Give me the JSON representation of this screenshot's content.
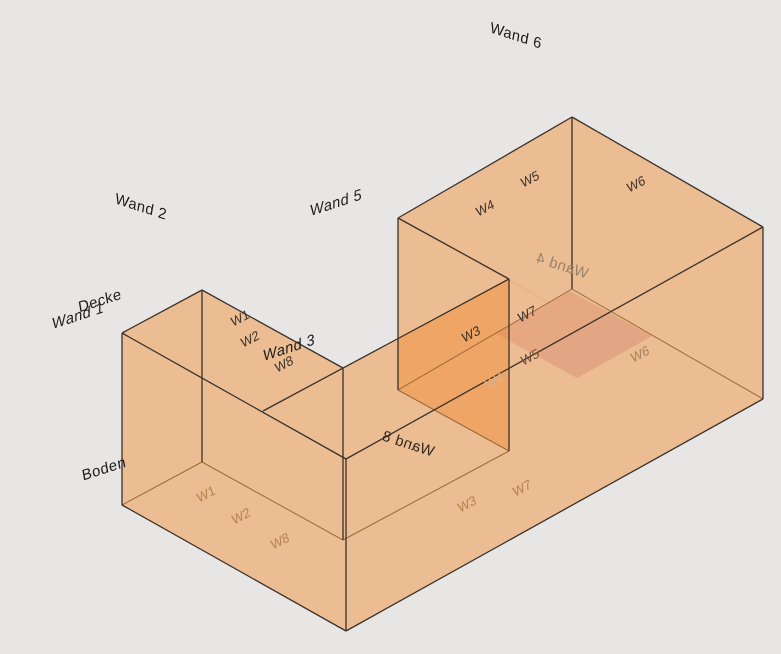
{
  "scene": {
    "background": "#e7e6e4",
    "face_color": "#f48c2e",
    "face_opacity": 0.26,
    "pink_face_color": "#cd6e64",
    "pink_face_opacity": 0.28,
    "edge_color": "#3a322b",
    "hidden_edge_color": "#9a6a38",
    "view_width": 781,
    "view_height": 654
  },
  "geometry": {
    "points": {
      "B": [
        122,
        333
      ],
      "A": [
        202,
        290
      ],
      "C": [
        343,
        368
      ],
      "D": [
        263,
        411
      ],
      "M": [
        509,
        279
      ],
      "W": [
        398,
        218
      ],
      "N": [
        572,
        117
      ],
      "E": [
        763,
        227
      ],
      "S": [
        346,
        459
      ],
      "T": [
        588,
        325
      ],
      "Bf": [
        122,
        505
      ],
      "Af": [
        202,
        462
      ],
      "Cf": [
        343,
        540
      ],
      "Mf": [
        509,
        451
      ],
      "Wf": [
        398,
        390
      ],
      "Nf": [
        572,
        289
      ],
      "Ef": [
        763,
        399
      ],
      "Sf": [
        346,
        631
      ],
      "P1": [
        570,
        291
      ],
      "P2": [
        652,
        336
      ],
      "P3": [
        577,
        378
      ],
      "P4": [
        495,
        333
      ]
    },
    "faces": [
      {
        "id": "floor-boden",
        "pts": [
          "Bf",
          "Af",
          "Cf",
          "Mf",
          "Wf",
          "Nf",
          "Ef",
          "Sf"
        ]
      },
      {
        "id": "wall-north-tall",
        "pts": [
          "W",
          "N",
          "Nf",
          "Wf"
        ]
      },
      {
        "id": "wall-east-tall",
        "pts": [
          "N",
          "E",
          "Ef",
          "Nf"
        ]
      },
      {
        "id": "wall-west-tall",
        "pts": [
          "W",
          "M",
          "Mf",
          "Wf"
        ]
      },
      {
        "id": "wall-notch-north",
        "pts": [
          "C",
          "M",
          "Mf",
          "Cf"
        ]
      },
      {
        "id": "wall-left-ne",
        "pts": [
          "A",
          "C",
          "Cf",
          "Af"
        ]
      },
      {
        "id": "wall-left-nw",
        "pts": [
          "B",
          "A",
          "Af",
          "Bf"
        ]
      },
      {
        "id": "wall-left-sw",
        "pts": [
          "B",
          "S",
          "Sf",
          "Bf"
        ]
      },
      {
        "id": "wall-south-long",
        "pts": [
          "S",
          "E",
          "Ef",
          "Sf"
        ]
      },
      {
        "id": "floor-highlight",
        "pts": [
          "P1",
          "P2",
          "P3",
          "P4"
        ],
        "special": "pink"
      },
      {
        "id": "roof-tall-wing",
        "pts": [
          "W",
          "N",
          "E",
          "T"
        ]
      },
      {
        "id": "ceiling-strip",
        "pts": [
          "D",
          "M",
          "T",
          "S"
        ]
      },
      {
        "id": "ceiling-left-panel",
        "pts": [
          "B",
          "A",
          "C",
          "D"
        ]
      }
    ],
    "edges": [
      [
        "B",
        "A"
      ],
      [
        "A",
        "C"
      ],
      [
        "D",
        "M"
      ],
      [
        "W",
        "M"
      ],
      [
        "W",
        "N"
      ],
      [
        "N",
        "E"
      ],
      [
        "S",
        "E"
      ],
      [
        "B",
        "S"
      ],
      [
        "B",
        "Bf"
      ],
      [
        "A",
        "Af"
      ],
      [
        "C",
        "Cf"
      ],
      [
        "S",
        "Sf"
      ],
      [
        "M",
        "Mf"
      ],
      [
        "W",
        "Wf"
      ],
      [
        "N",
        "Nf"
      ],
      [
        "E",
        "Ef"
      ],
      [
        "Bf",
        "Sf"
      ],
      [
        "Sf",
        "Ef"
      ]
    ],
    "hidden_edges": [
      [
        "Bf",
        "Af"
      ],
      [
        "Af",
        "Cf"
      ],
      [
        "Cf",
        "Mf"
      ],
      [
        "Mf",
        "Wf"
      ],
      [
        "Wf",
        "Nf"
      ],
      [
        "Nf",
        "Ef"
      ]
    ]
  },
  "labels": {
    "large": [
      {
        "id": "wall-label-wand-6",
        "text": "Wand 6",
        "x": 516,
        "y": 36,
        "rot": 18,
        "skew": 8,
        "mirror": false,
        "italic": false,
        "color": "#1c1c1c"
      },
      {
        "id": "wall-label-wand-2",
        "text": "Wand 2",
        "x": 141,
        "y": 207,
        "rot": 18,
        "skew": 8,
        "mirror": false,
        "italic": false,
        "color": "#1c1c1c"
      },
      {
        "id": "wall-label-wand-5",
        "text": "Wand 5",
        "x": 336,
        "y": 203,
        "rot": -18,
        "skew": -8,
        "mirror": false,
        "italic": true,
        "color": "#1c1c1c"
      },
      {
        "id": "ceiling-label-decke",
        "text": "Decke",
        "x": 100,
        "y": 301,
        "rot": -18,
        "skew": -8,
        "mirror": false,
        "italic": false,
        "color": "#1c1c1c"
      },
      {
        "id": "wall-label-wand-1",
        "text": "Wand 1",
        "x": 78,
        "y": 316,
        "rot": -18,
        "skew": -8,
        "mirror": false,
        "italic": true,
        "color": "#1c1c1c"
      },
      {
        "id": "wall-label-wand-3",
        "text": "Wand 3",
        "x": 289,
        "y": 348,
        "rot": -18,
        "skew": -8,
        "mirror": false,
        "italic": true,
        "color": "#1c1c1c"
      },
      {
        "id": "floor-label-boden",
        "text": "Boden",
        "x": 104,
        "y": 469,
        "rot": -18,
        "skew": -8,
        "mirror": false,
        "italic": false,
        "color": "#1c1c1c"
      },
      {
        "id": "wall-label-wand-4",
        "text": "Wand 4",
        "x": 562,
        "y": 266,
        "rot": 18,
        "skew": 0,
        "mirror": true,
        "italic": false,
        "color": "#97846d"
      },
      {
        "id": "wall-label-wand-8",
        "text": "Wand 8",
        "x": 408,
        "y": 444,
        "rot": 18,
        "skew": 0,
        "mirror": true,
        "italic": false,
        "color": "#33291f"
      }
    ],
    "small": [
      {
        "id": "surface-label-w1-ceiling",
        "text": "W1",
        "x": 240,
        "y": 318,
        "color": "#3a322b"
      },
      {
        "id": "surface-label-w2-ceiling",
        "text": "W2",
        "x": 250,
        "y": 339,
        "color": "#3a322b"
      },
      {
        "id": "surface-label-w8-ceiling",
        "text": "W8",
        "x": 284,
        "y": 364,
        "color": "#3a322b"
      },
      {
        "id": "surface-label-w4-roof",
        "text": "W4",
        "x": 485,
        "y": 208,
        "color": "#3a322b"
      },
      {
        "id": "surface-label-w5-roof",
        "text": "W5",
        "x": 530,
        "y": 179,
        "color": "#3a322b"
      },
      {
        "id": "surface-label-w6-roof",
        "text": "W6",
        "x": 636,
        "y": 184,
        "color": "#3a322b"
      },
      {
        "id": "surface-label-w3-wall",
        "text": "W3",
        "x": 471,
        "y": 334,
        "color": "#3a322b"
      },
      {
        "id": "surface-label-w7-wall",
        "text": "W7",
        "x": 527,
        "y": 314,
        "color": "#3a322b"
      },
      {
        "id": "surface-label-w5-inner",
        "text": "W5",
        "x": 530,
        "y": 357,
        "color": "#6d4c35"
      },
      {
        "id": "surface-label-w4-inner",
        "text": "W4",
        "x": 494,
        "y": 381,
        "color": "#d9b38c"
      },
      {
        "id": "surface-label-w6-inner",
        "text": "W6",
        "x": 640,
        "y": 354,
        "color": "#a8805c"
      },
      {
        "id": "surface-label-w1-floor",
        "text": "W1",
        "x": 206,
        "y": 494,
        "color": "#b5824f"
      },
      {
        "id": "surface-label-w2-floor",
        "text": "W2",
        "x": 241,
        "y": 516,
        "color": "#b5824f"
      },
      {
        "id": "surface-label-w8-floor",
        "text": "W8",
        "x": 280,
        "y": 541,
        "color": "#b5824f"
      },
      {
        "id": "surface-label-w3-floor",
        "text": "W3",
        "x": 467,
        "y": 504,
        "color": "#b5824f"
      },
      {
        "id": "surface-label-w7-floor",
        "text": "W7",
        "x": 522,
        "y": 488,
        "color": "#b5824f"
      }
    ]
  }
}
